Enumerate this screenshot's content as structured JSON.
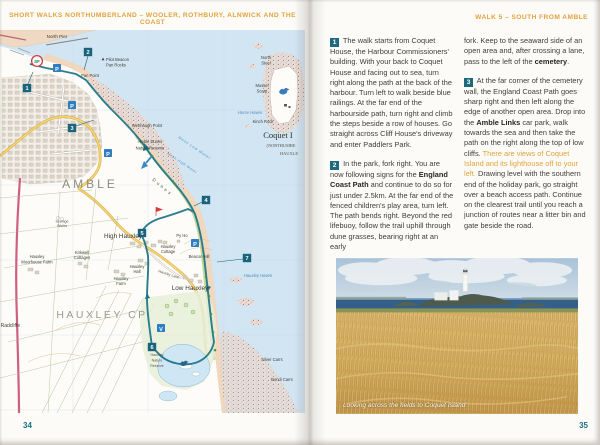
{
  "left_page": {
    "header": "SHORT WALKS NORTHUMBERLAND – WOOLER, ROTHBURY, ALNWICK AND THE COAST",
    "page_number": "34",
    "map": {
      "markers": {
        "start_finish": "SF",
        "w1": "1",
        "w2": "2",
        "w3": "3",
        "w4": "4",
        "w5": "5",
        "w6": "6",
        "w7": "7",
        "parking": "P",
        "visitor_centre": "V"
      },
      "labels": {
        "north_pier": "North Pier",
        "pilot_beacon": "Pilot Beacon",
        "pan_rocks": "Pan Rocks",
        "pan_point": "Pan Point",
        "wenhaugh_point": "Wenhaugh Point",
        "amble_dunes_1": "Amble Dunes",
        "amble_dunes_2": "Nature Reserve",
        "mean_low_water": "Mean Low Water",
        "mean_high_water": "Mean High Water",
        "dunes": "Dunes",
        "north_steel_1": "North",
        "north_steel_2": "Steel",
        "mussel_scarp_1": "Mussel",
        "mussel_scarp_2": "Scarp",
        "horse_haven": "Horse Haven",
        "kinch_rock": "Kinch Rock",
        "coquet_island": "Coquet I",
        "coquet_island_sub1": "(NORTHUMBE",
        "coquet_island_sub2": "HAUXLE",
        "amble": "AMBLE",
        "sewage_1": "Sewage",
        "sewage_2": "Works",
        "high_hauxley": "High Hauxley",
        "kirkwell_1": "Kirkwell",
        "kirkwell_2": "Cottages",
        "moorhouse_1": "Hauxley",
        "moorhouse_2": "Moorhouse Farm",
        "cottage_1": "Hauxley",
        "cottage_2": "Cottage",
        "py_ho": "Py Ho",
        "beacon_hill": "Beacon Hill",
        "hall_1": "Hauxley",
        "hall_2": "Hall",
        "farm_1": "Hauxley",
        "farm_2": "Farm",
        "hauxley_lane": "Hauxley Lane",
        "low_hauxley": "Low Hauxley",
        "hauxley_haven": "Hauxley Haven",
        "hauxley_cp": "HAUXLEY CP",
        "radcliffe": "Radcliffe",
        "nature_reserve_1": "Hauxley",
        "nature_reserve_2": "Nature",
        "nature_reserve_3": "Reserve",
        "silver_carrs": "Silver Carrs",
        "bondi_carrs": "Bondi Carrs"
      },
      "colors": {
        "sea": "#D2E5F2",
        "sand": "#F0D7BD",
        "route_teal": "#1B7487",
        "road_yellow": "#F6D56C",
        "road_magenta": "#CF5F82",
        "marker_teal": "#19647A",
        "parking_blue": "#2F7DC2",
        "start_finish_ring": "#D23B3B"
      }
    }
  },
  "right_page": {
    "header": "WALK 5 – SOUTH FROM AMBLE",
    "page_number": "35",
    "accent_color": "#E2A33C",
    "step_square_color": "#1D6A7D",
    "columns": [
      {
        "blocks": [
          {
            "number": "1",
            "segments": [
              {
                "style": "normal",
                "text": "The walk starts from Coquet House, the Harbour Commissioners' building. With your back to Coquet House and facing out to sea, turn right along the path at the back of the harbour. Turn left to walk beside blue railings. At the far end of the harbourside path, turn right and climb the steps beside a row of houses. Go straight across Cliff House's driveway and enter Paddlers Park."
              }
            ]
          },
          {
            "number": "2",
            "segments": [
              {
                "style": "normal",
                "text": "In the park, fork right. You are now following signs for the "
              },
              {
                "style": "bold",
                "text": "England Coast Path"
              },
              {
                "style": "normal",
                "text": " and continue to do so for just under 2.5km. At the far end of the fenced children's play area, turn left. The path bends right. Beyond the red lifebuoy, follow the trail uphill through dune grasses, bearing right at an early"
              }
            ]
          }
        ]
      },
      {
        "blocks": [
          {
            "segments": [
              {
                "style": "normal",
                "text": "fork. Keep to the seaward side of an open area and, after crossing a lane, pass to the left of the "
              },
              {
                "style": "bold",
                "text": "cemetery"
              },
              {
                "style": "normal",
                "text": "."
              }
            ]
          },
          {
            "number": "3",
            "segments": [
              {
                "style": "normal",
                "text": "At the far corner of the cemetery wall, the England Coast Path goes sharp right and then left along the edge of another open area. Drop into the "
              },
              {
                "style": "bold",
                "text": "Amble Links"
              },
              {
                "style": "normal",
                "text": " car park, walk towards the sea and then take the path on the right along the top of low cliffs. "
              },
              {
                "style": "highlight",
                "text": "There are views of Coquet Island and its lighthouse off to your left."
              },
              {
                "style": "normal",
                "text": " Drawing level with the southern end of the holiday park, go straight over a beach access path. Continue on the clearest trail until you reach a junction of routes near a litter bin and gate beside the road."
              }
            ]
          }
        ]
      }
    ],
    "photo": {
      "caption": "Looking across the fields to Coquet Island",
      "subject": "coquet-island-lighthouse-across-fields"
    }
  }
}
